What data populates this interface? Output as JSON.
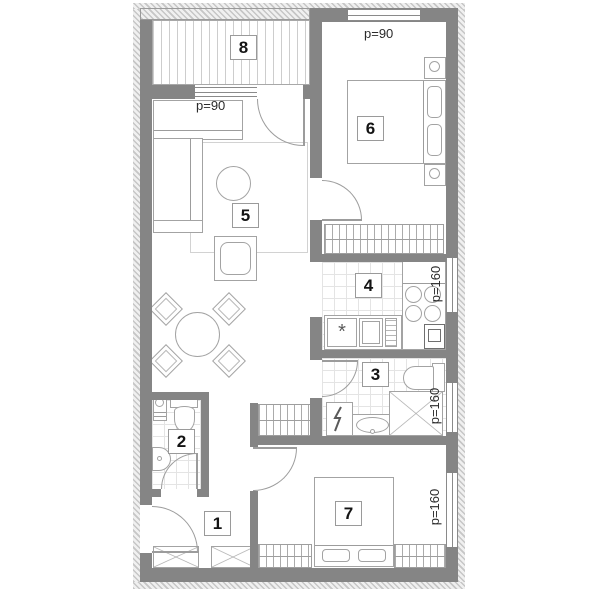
{
  "floorplan": {
    "room_numbers": {
      "r1": "1",
      "r2": "2",
      "r3": "3",
      "r4": "4",
      "r5": "5",
      "r6": "6",
      "r7": "7",
      "r8": "8"
    },
    "window_labels": {
      "living_balcony_window": "p=90",
      "bedroom6_window": "p=90",
      "kitchen_window": "p=160",
      "bathroom_window": "p=160",
      "bedroom7_window": "p=160"
    },
    "symbols": {
      "kitchen_sink_asterisk": "*"
    },
    "colors": {
      "wall": "#858585",
      "furniture_line": "#a3a3a3",
      "tile_line": "#e4e4e4",
      "text": "#1c1c1c",
      "background": "#ffffff"
    }
  }
}
